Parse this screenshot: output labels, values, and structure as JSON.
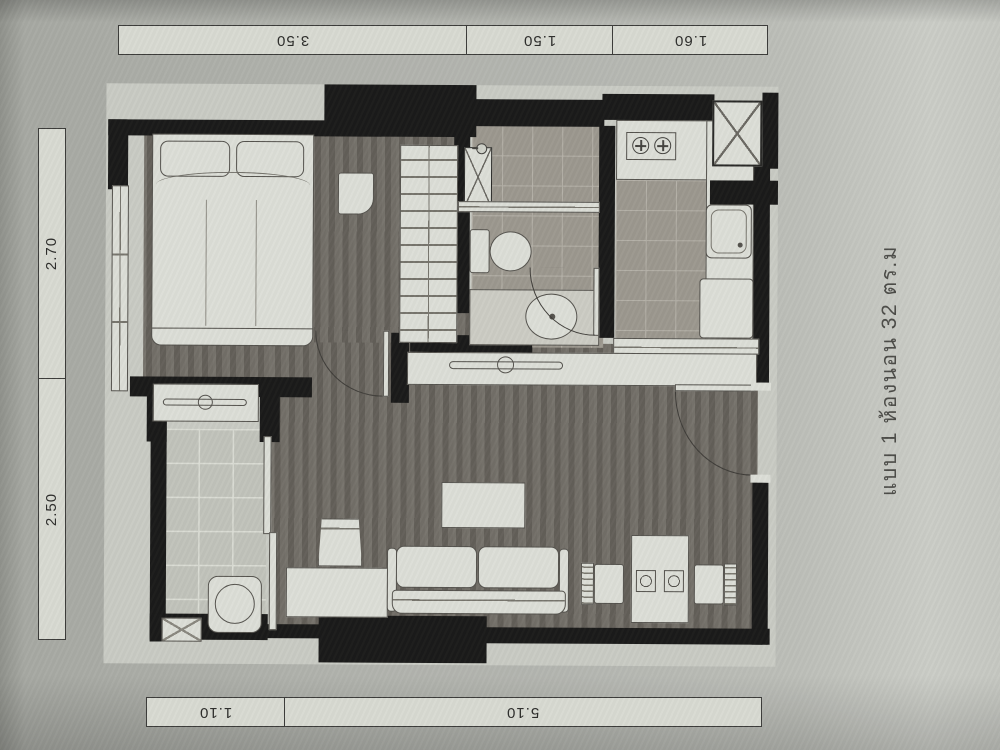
{
  "caption": {
    "text": "แบบ 1 ห้องนอน 32 ตร.ม"
  },
  "dimensions": {
    "top": [
      {
        "label": "3.50"
      },
      {
        "label": "1.50"
      },
      {
        "label": "1.60"
      }
    ],
    "left": [
      {
        "label": "2.70"
      },
      {
        "label": "2.50"
      }
    ],
    "bottom": [
      {
        "label": "1.10"
      },
      {
        "label": "5.10"
      }
    ]
  },
  "colors": {
    "page": "#b2b4ae",
    "paper": "#c9cbc4",
    "wall": "#1b1b1a",
    "floor-dark": "#6e6a63",
    "tile": "#9c988f",
    "tile-line": "#b5b1a8",
    "balcony-tile": "#c1c3bb",
    "balcony-line": "#dadcd4",
    "furniture": "#dcded7",
    "outline": "#55534e",
    "bar-bg": "#d8dad2",
    "bar-border": "#3c3c3a",
    "label": "#2e2e2c",
    "caption": "#4c4c48"
  }
}
